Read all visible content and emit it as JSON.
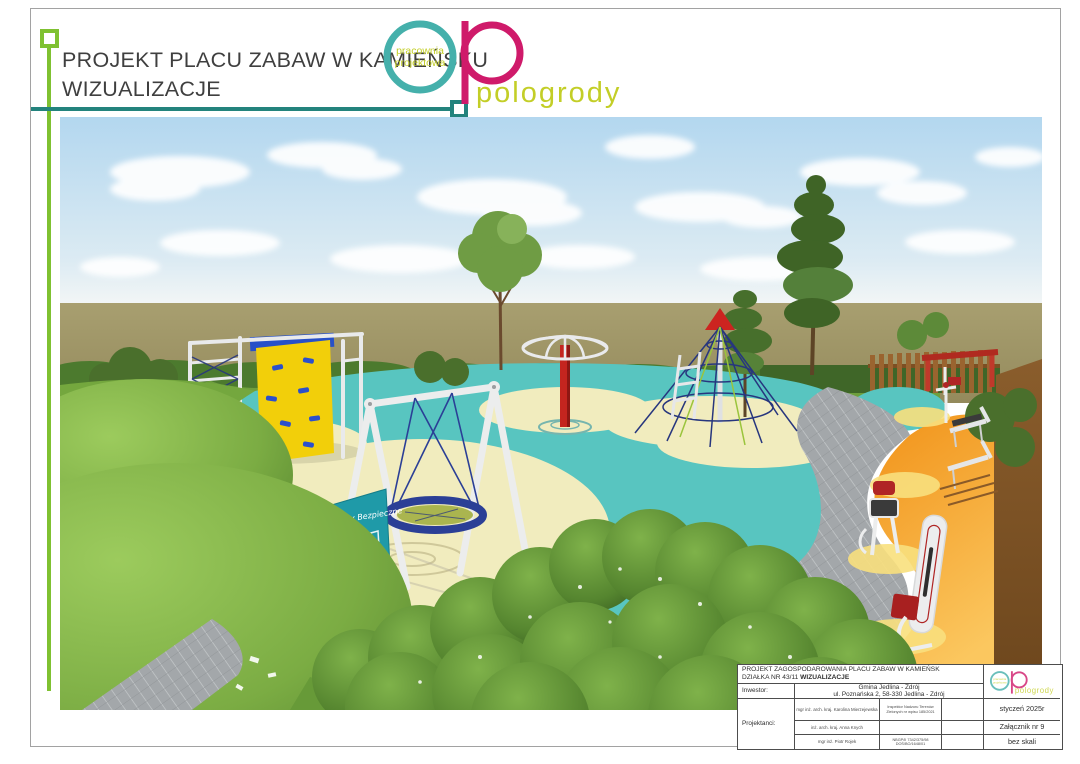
{
  "page": {
    "header": {
      "title_line1": "PROJEKT PLACU ZABAW W KAMIEŃSKU",
      "title_line2": "WIZUALIZACJE"
    },
    "logo": {
      "circle_text_line1": "pracownia",
      "circle_text_line2": "projektowa",
      "wordmark": "pologrody",
      "colors": {
        "teal": "#45b0ab",
        "magenta": "#cf1a6a",
        "lime": "#c3ce27"
      }
    },
    "scene": {
      "sign_text": "Zabawy Bezpieczne",
      "colors": {
        "sky": "#b3d7ef",
        "ground": "#a39a6b",
        "rubber_teal": "#58c5c0",
        "rubber_cream": "#f1ecbe",
        "rubber_orange": "#f6a21d",
        "grass": "#7bac43",
        "equipment_red": "#c4251f",
        "equipment_yellow": "#f2cf0a",
        "equipment_blue": "#2b50cc",
        "pavers_gray": "#a3a7aa"
      }
    },
    "title_block": {
      "project_line1": "PROJEKT ZAGOSPODAROWANIA PLACU ZABAW W KAMIEŃSK",
      "project_line2_prefix": "DZIAŁKA NR 43/11 ",
      "project_line2_bold": "WIZUALIZACJE",
      "investor_label": "Inwestor:",
      "investor_value_line1": "Gmina Jedlina - Zdrój",
      "investor_value_line2": "ul. Poznańska 2, 58-330  Jedlina - Zdrój",
      "designers_label": "Projektanci:",
      "designers": [
        {
          "name": "mgr inż. arch. kraj. Karolina Mierzejewska",
          "credential": "Inspektor Nadzoru Terenów Zielonych nr wpisu 185/2021"
        },
        {
          "name": "inż. arch. kraj. Anna Knych",
          "credential": ""
        },
        {
          "name": "mgr inż. Piotr Rojek",
          "credential": "NBGP/II 7342/375/98 DOŚ/BO/1648/01"
        }
      ],
      "date": "styczeń 2025r",
      "attachment": "Załącznik nr 9",
      "scale": "bez skali"
    }
  }
}
